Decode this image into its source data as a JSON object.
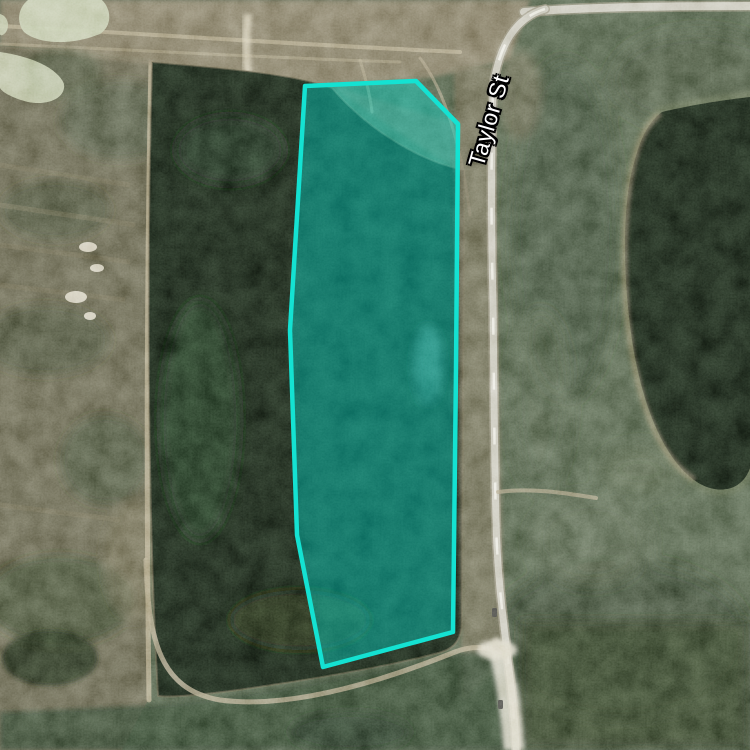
{
  "map": {
    "view": "satellite",
    "road_label": "Taylor St",
    "parcel": {
      "points": "305,86 416,81 458,124 456,370 453,632 323,667 297,535 290,330",
      "outline_color": "#14E2D2",
      "fill_color": "#00DACB",
      "fill_opacity": "0.42",
      "outline_width": "4.5"
    },
    "colors": {
      "forest": "#44533b",
      "water-dark": "#121a11",
      "road": "#c2c0b2",
      "dirt": "#7c7258",
      "pond-pale": "#bcc4a3",
      "sand": "#d8d4c2"
    }
  }
}
